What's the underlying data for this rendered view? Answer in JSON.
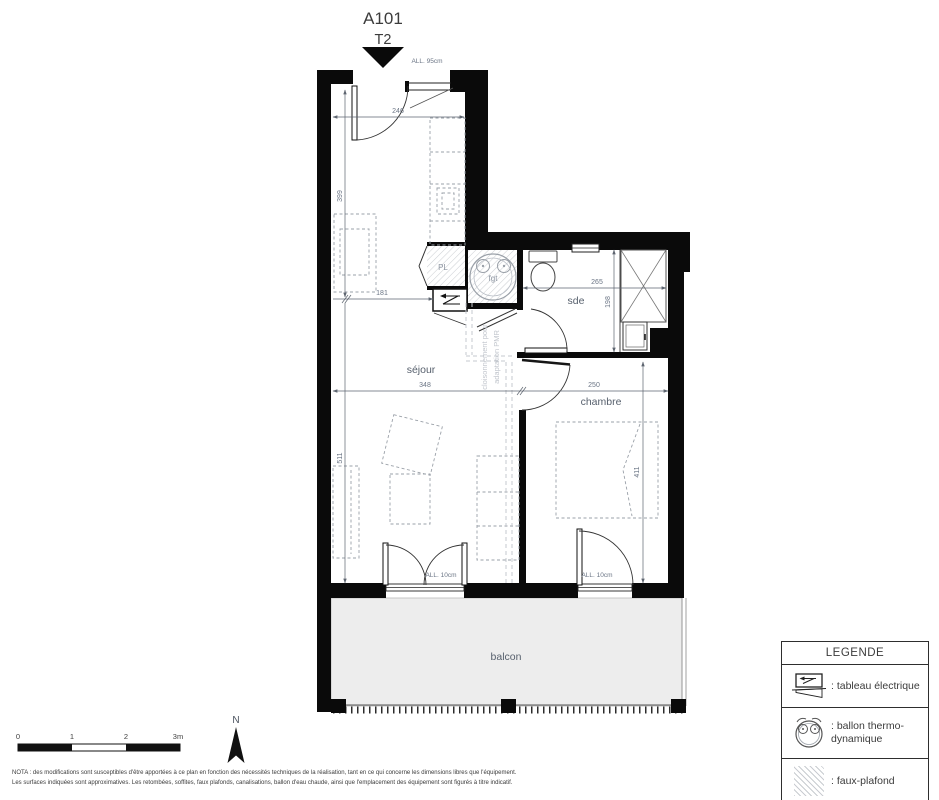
{
  "title": {
    "unit": "A101",
    "type": "T2"
  },
  "entrance": {
    "sill_label": "ALL. 95cm"
  },
  "rooms": {
    "sejour": "séjour",
    "chambre": "chambre",
    "sde": "sde",
    "balcon": "balcon",
    "closet": "PL",
    "water_heater": "fgt"
  },
  "dims": {
    "entry_width": "246",
    "entry_length": "399",
    "entry_clear": "181",
    "sejour_width": "348",
    "sejour_length": "511",
    "chambre_width": "250",
    "chambre_length": "411",
    "sde_width": "265",
    "sde_length": "198"
  },
  "doors": {
    "sejour_balcony_sill": "ALL. 10cm",
    "chambre_balcony_sill": "ALL. 10cm"
  },
  "pmr": {
    "line1": "cloisonnement pour",
    "line2": "adaptation PMR"
  },
  "compass": {
    "label": "N"
  },
  "scale": {
    "t0": "0",
    "t1": "1",
    "t2": "2",
    "t3": "3m"
  },
  "notes": {
    "line1": "NOTA : des modifications sont susceptibles d'être apportées à ce plan en fonction des nécessités techniques de la réalisation, tant en ce qui concerne les dimensions libres que l'équipement.",
    "line2": "Les surfaces indiquées sont approximatives. Les retombées, soffites, faux plafonds, canalisations, ballon d'eau chaude, ainsi que l'emplacement des équipement sont figurés à titre indicatif."
  },
  "legend": {
    "title": "LEGENDE",
    "electrical": ": tableau électrique",
    "heater_line1": ": ballon thermo-",
    "heater_line2": "dynamique",
    "ceiling": ": faux-plafond"
  },
  "colors": {
    "wall": "#0a0a0a",
    "balcony_fill": "#ededed",
    "hatch": "#cdd0d4",
    "dim_text": "#6b7585",
    "room_text": "#57606d"
  }
}
